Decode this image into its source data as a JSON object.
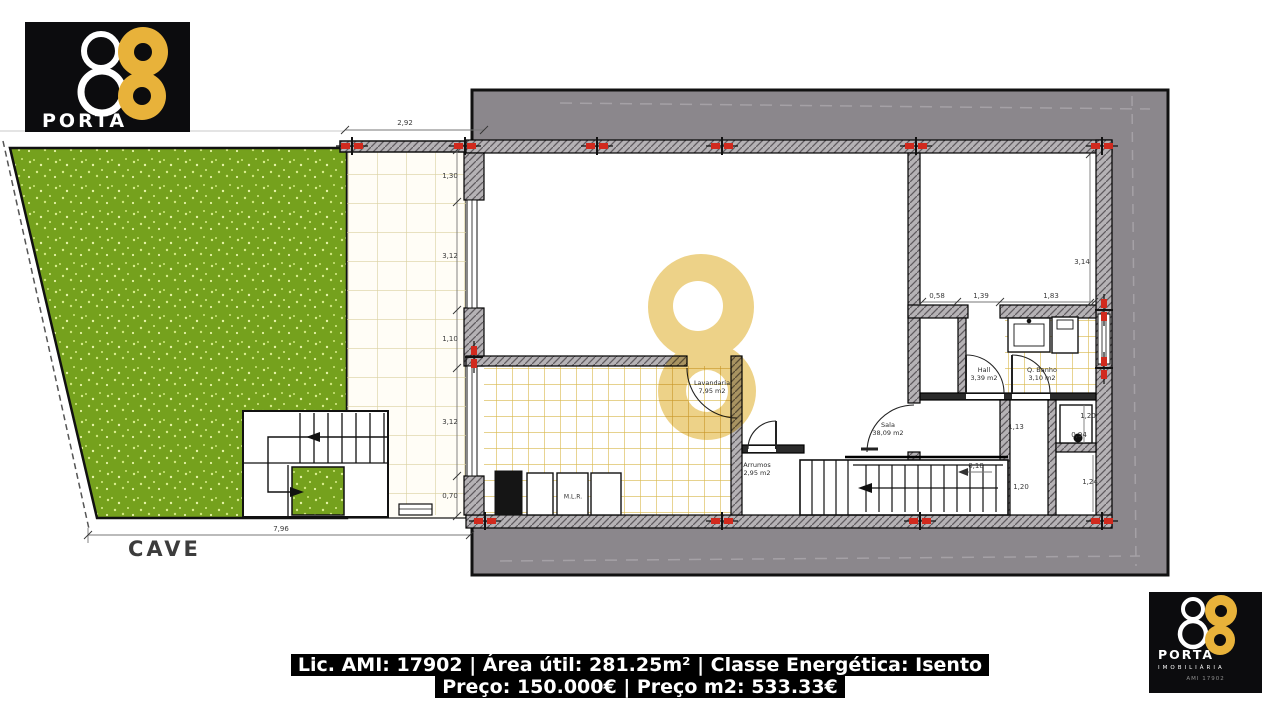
{
  "brand": {
    "name": "PORTA",
    "number": "8",
    "subtitle": "IMOBILIÁRIA",
    "license_small": "AMI 17902",
    "gold": "#e8b23a",
    "background": "#0c0c0e"
  },
  "caption": {
    "line1": "Lic. AMI: 17902 | Área útil: 281.25m² | Classe Energética: Isento",
    "line2": "Preço: 150.000€ | Preço m2: 533.33€"
  },
  "plan": {
    "floor_label": "CAVE",
    "colors": {
      "grass": "#75a11d",
      "earth": "#8b878c",
      "tile_line": "#d8b84a",
      "patio_line": "#d9d0a0",
      "marker_red": "#d12a1e",
      "watermark_gold": "#e9c76a"
    },
    "rooms": [
      {
        "name": "Lavandaria",
        "area": "7,95 m2",
        "x": 712,
        "y": 388
      },
      {
        "name": "Sala",
        "area": "38,09 m2",
        "x": 888,
        "y": 430
      },
      {
        "name": "Arrumos",
        "area": "2,95 m2",
        "x": 757,
        "y": 470
      },
      {
        "name": "Hall",
        "area": "3,39 m2",
        "x": 984,
        "y": 375
      },
      {
        "name": "Q. Banho",
        "area": "3,10 m2",
        "x": 1042,
        "y": 375
      }
    ],
    "equipment_labels": [
      {
        "text": "M.L.R.",
        "x": 573,
        "y": 497
      }
    ],
    "dimensions": [
      {
        "text": "2,92",
        "x": 405,
        "y": 123
      },
      {
        "text": "1,30",
        "x": 450,
        "y": 176
      },
      {
        "text": "3,12",
        "x": 450,
        "y": 256
      },
      {
        "text": "1,10",
        "x": 450,
        "y": 339
      },
      {
        "text": "3,12",
        "x": 450,
        "y": 422
      },
      {
        "text": "0,70",
        "x": 450,
        "y": 496
      },
      {
        "text": "7,96",
        "x": 281,
        "y": 529
      },
      {
        "text": "3,14",
        "x": 1082,
        "y": 262
      },
      {
        "text": "0,58",
        "x": 937,
        "y": 296
      },
      {
        "text": "1,39",
        "x": 981,
        "y": 296
      },
      {
        "text": "1,83",
        "x": 1051,
        "y": 296
      },
      {
        "text": "1,13",
        "x": 1016,
        "y": 427
      },
      {
        "text": "1,20",
        "x": 1088,
        "y": 416
      },
      {
        "text": "0,94",
        "x": 1079,
        "y": 435
      },
      {
        "text": "1,24",
        "x": 1090,
        "y": 482
      },
      {
        "text": "1,20",
        "x": 1021,
        "y": 487
      },
      {
        "text": "0,18",
        "x": 976,
        "y": 466
      }
    ]
  }
}
